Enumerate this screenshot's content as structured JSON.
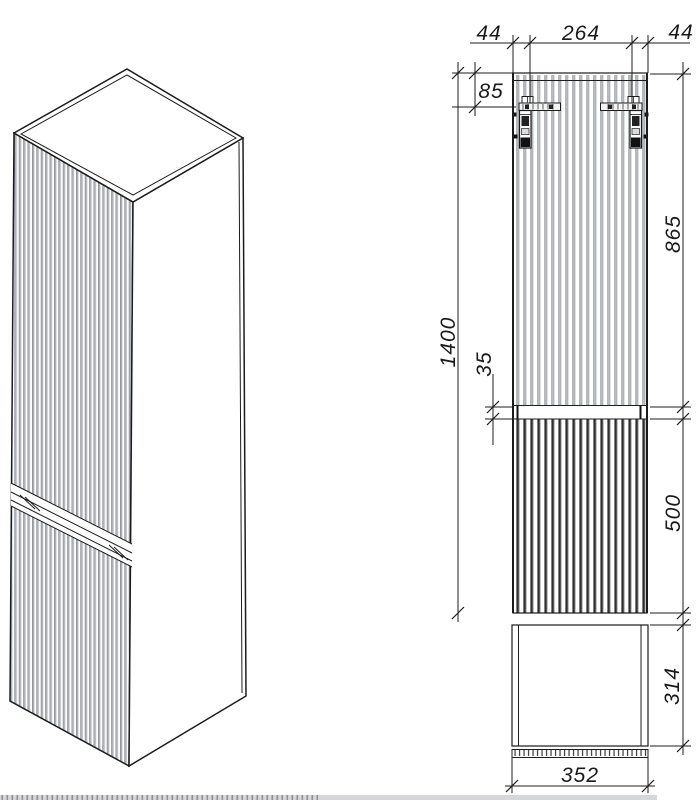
{
  "drawing": {
    "views": {
      "isometric": "isometric-cabinet-view",
      "front": "front-elevation-view",
      "plan": "top-plan-view"
    },
    "dimensions": {
      "top_left_offset": "44",
      "bracket_spacing": "264",
      "top_right_offset": "44",
      "bracket_drop": "85",
      "height_total": "1400",
      "upper_door_height": "865",
      "door_gap": "35",
      "lower_door_height": "500",
      "depth": "314",
      "width": "352"
    },
    "colors": {
      "line": "#1c1c1c",
      "flute_light": "#b6bbc0",
      "flute_dark": "#2e2e2e",
      "flute_iso": "#a9aeb3",
      "hardware_dark": "#1a1a1a"
    }
  }
}
